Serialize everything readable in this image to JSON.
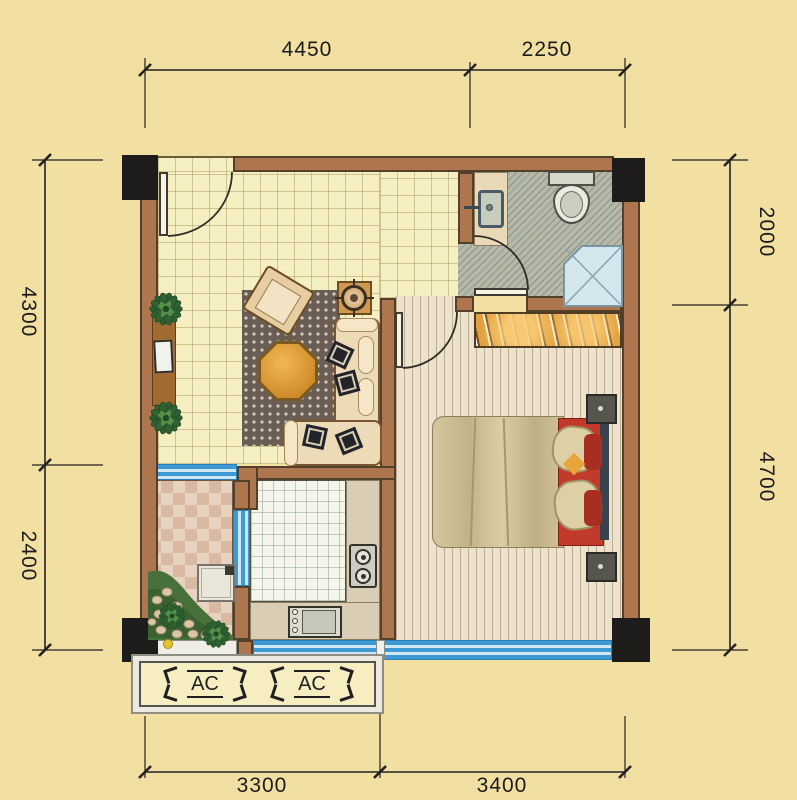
{
  "drawing": {
    "type": "residential floor plan",
    "dim_top": [
      {
        "label": "4450"
      },
      {
        "label": "2250"
      }
    ],
    "dim_bottom": [
      {
        "label": "3300"
      },
      {
        "label": "3400"
      }
    ],
    "dim_left": [
      {
        "label": "4300"
      },
      {
        "label": "2400"
      }
    ],
    "dim_right": [
      {
        "label": "2000"
      },
      {
        "label": "4700"
      }
    ],
    "ac_units": [
      {
        "label": "AC"
      },
      {
        "label": "AC"
      }
    ]
  },
  "palette": {
    "background": "#f2dfa2",
    "wall": "#ad764e",
    "wall_outline": "#54402a",
    "column": "#1d1c1a",
    "window_blue": "#3d9ad4",
    "window_light": "#cfe7f5",
    "living_floor": "#f5efc2",
    "bath_floor": "#b5b9a9",
    "bedroom_floor": "#ece2cd",
    "kitchen_floor": "#f4f6ec",
    "balcony_tile": "#d9b9a1",
    "rug": "#6a5d54",
    "sofa": "#eddab6",
    "coffee_table": "#e8a83e",
    "bed_duvet": "#cfc198",
    "bed_red": "#c23a2c",
    "wardrobe": "#e2a13f",
    "dimension_ink": "#222222"
  }
}
